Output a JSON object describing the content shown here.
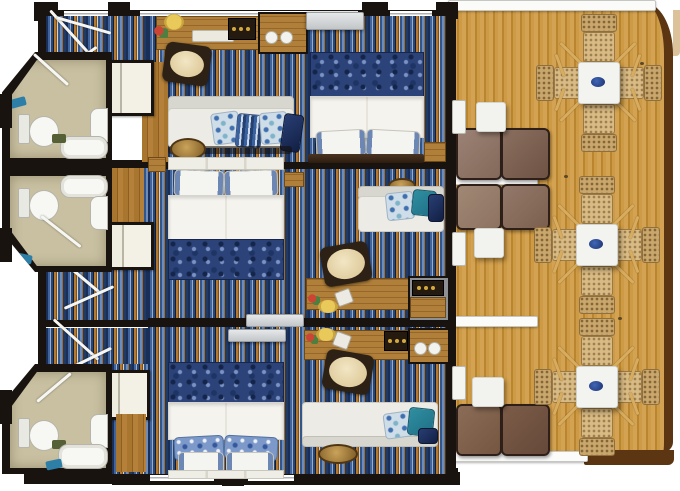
{
  "scene": {
    "type": "floor-plan",
    "subject": "Top-down rendered deck plan of three cruise-ship staterooms, each with en-suite bathroom, entry hall, wardrobe, desk, sofa and double bed, opening onto a shared teak balcony deck with dining sets and loungers",
    "text_content": "none - pictorial plan with no visible text"
  },
  "palette": {
    "wall": "#191310",
    "bathroom_floor": "#c9c0a2",
    "carpet_navy": "#203a66",
    "carpet_blue": "#41639c",
    "carpet_orange": "#b5792f",
    "carpet_cream": "#d9d2c2",
    "deck_wood": "#cd9a45",
    "deck_edge": "#5c3512",
    "wicker": "#c9a76c",
    "table_top": "#f3f3ef",
    "duvet_blue": "#2c4379",
    "sofa_fabric": "#edebe5",
    "lounger_brown": "#6f5343",
    "wood_furniture": "#a9762f",
    "accent_teal": "#2f8fa0",
    "accent_red": "#cc4433",
    "accent_gold": "#d4a93c"
  },
  "cabins": [
    {
      "name": "cabin-1",
      "position": "top",
      "bathroom_fixtures": [
        "toilet",
        "sink",
        "bathtub",
        "towel",
        "bath-mat"
      ],
      "furniture": [
        "entry-door-swing",
        "wardrobe",
        "writing-desk",
        "desk-chair",
        "desk-lamp",
        "flowers",
        "serving-tray",
        "safe-tray",
        "minibar-cabinet",
        "tea-cups",
        "wall-tv",
        "double-bed",
        "duvet",
        "bed-pillows",
        "sofa",
        "throw-pillows",
        "coffee-table",
        "nightstand"
      ]
    },
    {
      "name": "cabin-2",
      "position": "middle",
      "bathroom_fixtures": [
        "toilet",
        "sink",
        "bathtub",
        "towel"
      ],
      "furniture": [
        "entry-door-swing",
        "wardrobe",
        "writing-desk",
        "desk-chair",
        "flowers",
        "fruit-plate",
        "minibar-cabinet",
        "wall-tv",
        "double-bed",
        "duvet",
        "bed-pillows",
        "sofa",
        "throw-pillows",
        "serving-plate",
        "nightstand"
      ]
    },
    {
      "name": "cabin-3",
      "position": "bottom",
      "bathroom_fixtures": [
        "toilet",
        "sink",
        "bathtub",
        "towel",
        "bath-mat"
      ],
      "furniture": [
        "entry-door-swing",
        "wardrobe",
        "writing-desk",
        "desk-chair",
        "flowers",
        "fruit-plate",
        "safe-tray",
        "minibar-cabinet",
        "tea-cups",
        "wall-tv",
        "double-bed",
        "duvet",
        "bed-pillows",
        "sofa",
        "throw-pillows",
        "coffee-table"
      ]
    }
  ],
  "deck": {
    "name": "balcony-deck",
    "material": "teak planks",
    "table_sets": [
      {
        "left": 534,
        "top": 12
      },
      {
        "left": 532,
        "top": 174
      },
      {
        "left": 532,
        "top": 316
      }
    ],
    "chairs_per_table": 4,
    "side_tables": 3,
    "loungers": 3,
    "privacy_dividers": 2
  }
}
